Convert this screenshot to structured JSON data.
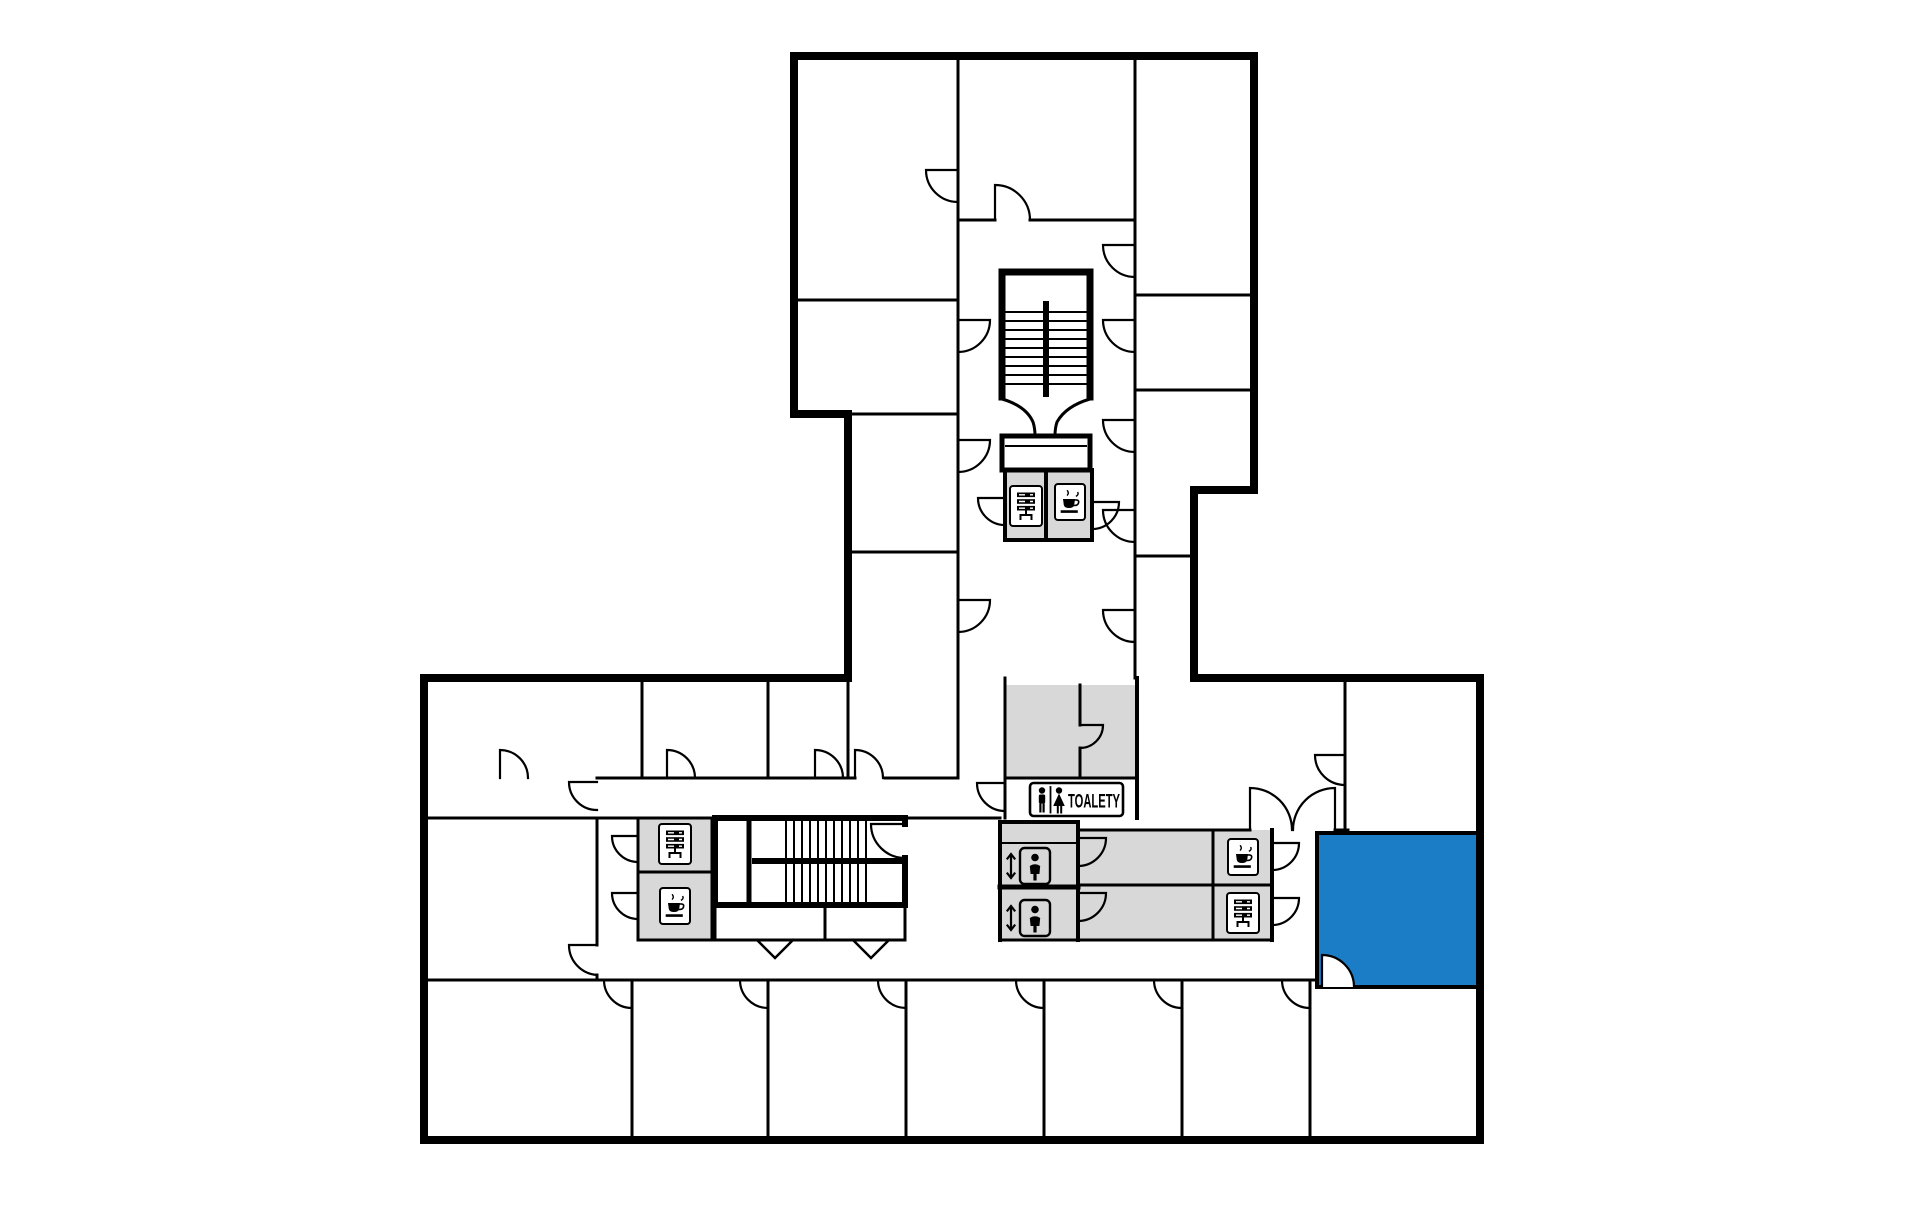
{
  "page": {
    "title": "Building floor plan",
    "type": "floor-plan"
  },
  "colors": {
    "background": "#ffffff",
    "wall": "#000000",
    "room": "#ffffff",
    "service-area": "#d8d8d8",
    "highlight": "#1b7dc6"
  },
  "signs": {
    "toilets_label": "TOALETY"
  },
  "inventory": {
    "coffee_points": 3,
    "printer_points": 3,
    "elevator_cars": 2,
    "stairwells": 2,
    "toilet_sign_figures": [
      "male",
      "female"
    ],
    "highlighted_rooms": 1
  }
}
